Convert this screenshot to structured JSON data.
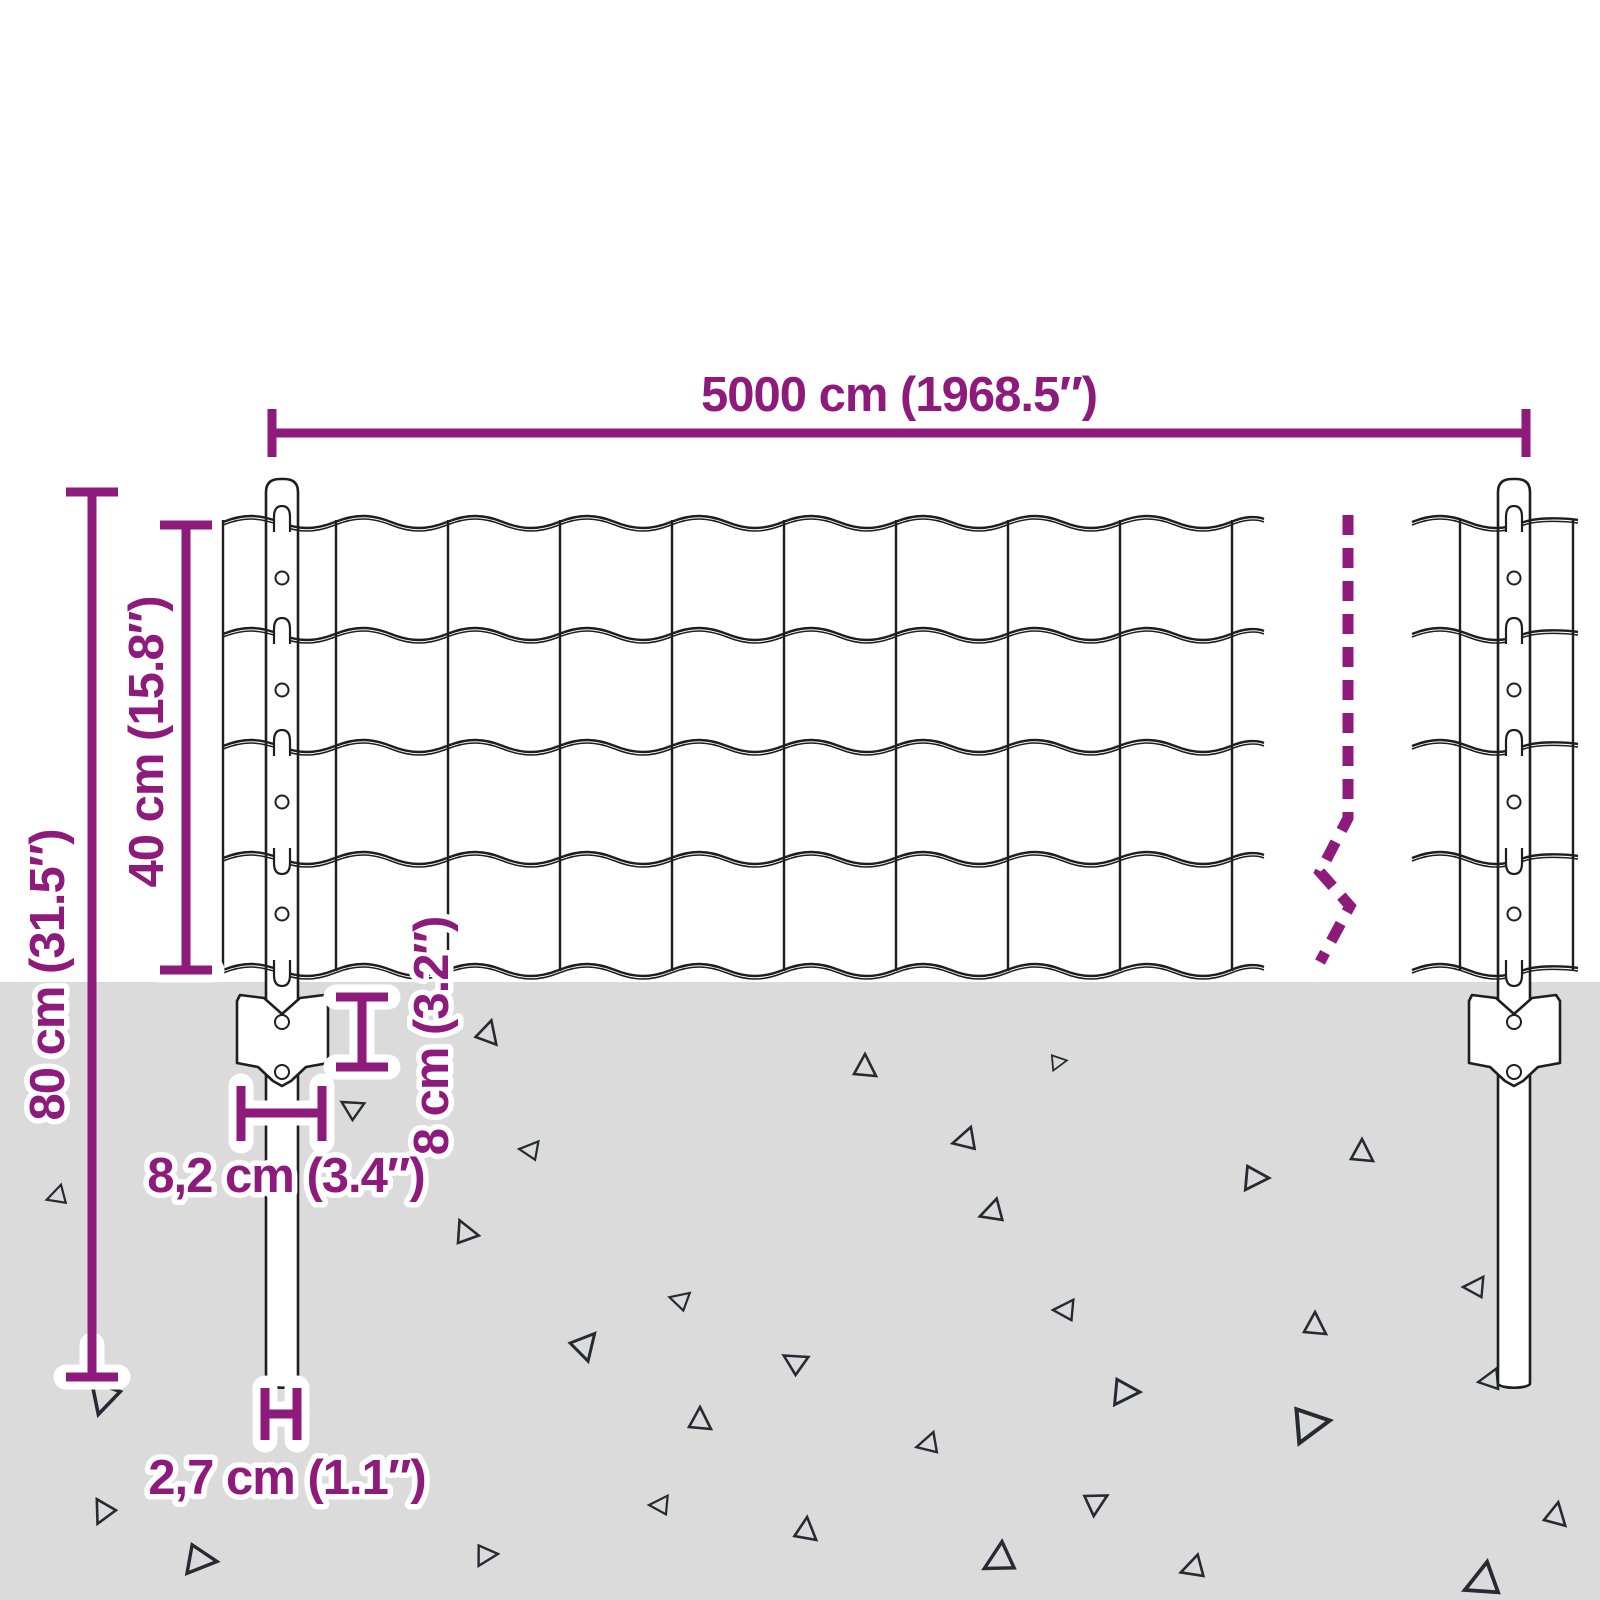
{
  "diagram": {
    "title": "fence-set-dimension-diagram",
    "labels": {
      "total_width": "5000 cm (1968.5″)",
      "post_height": "80 cm (31.5″)",
      "mesh_height": "40 cm (15.8″)",
      "bracket_height": "8 cm (3.2″)",
      "bracket_width": "8,2 cm (3.4″)",
      "post_diameter": "2,7 cm (1.1″)"
    },
    "colors": {
      "purple": "#8e1a7c",
      "ground": "#dbdbdb",
      "line": "#1e1e1e",
      "triangle": "#262a32",
      "background": "#ffffff"
    },
    "ground": {
      "triangles": [
        [
          103,
          1397,
          36,
          195
        ],
        [
          57,
          1196,
          22,
          250
        ],
        [
          103,
          1512,
          26,
          205
        ],
        [
          200,
          1560,
          34,
          95
        ],
        [
          352,
          1108,
          24,
          300
        ],
        [
          488,
          1033,
          26,
          15
        ],
        [
          530,
          1150,
          22,
          275
        ],
        [
          465,
          1232,
          26,
          335
        ],
        [
          585,
          1345,
          30,
          40
        ],
        [
          680,
          1300,
          22,
          285
        ],
        [
          700,
          1420,
          26,
          0
        ],
        [
          795,
          1362,
          26,
          300
        ],
        [
          865,
          1067,
          26,
          0
        ],
        [
          992,
          1212,
          26,
          250
        ],
        [
          1065,
          1310,
          24,
          270
        ],
        [
          1125,
          1392,
          30,
          90
        ],
        [
          1255,
          1178,
          28,
          90
        ],
        [
          1362,
          1152,
          26,
          0
        ],
        [
          1315,
          1325,
          26,
          0
        ],
        [
          1310,
          1424,
          40,
          80
        ],
        [
          1490,
          1380,
          24,
          260
        ],
        [
          928,
          1444,
          24,
          255
        ],
        [
          1096,
          1502,
          26,
          60
        ],
        [
          806,
          1530,
          26,
          5
        ],
        [
          999,
          1560,
          34,
          240
        ],
        [
          1193,
          1568,
          26,
          250
        ],
        [
          1482,
          1582,
          38,
          245
        ],
        [
          1556,
          1515,
          26,
          10
        ],
        [
          486,
          1555,
          24,
          85
        ],
        [
          660,
          1505,
          22,
          270
        ],
        [
          965,
          1140,
          26,
          255
        ],
        [
          1058,
          1062,
          18,
          80
        ],
        [
          1475,
          1287,
          24,
          270
        ]
      ]
    }
  }
}
